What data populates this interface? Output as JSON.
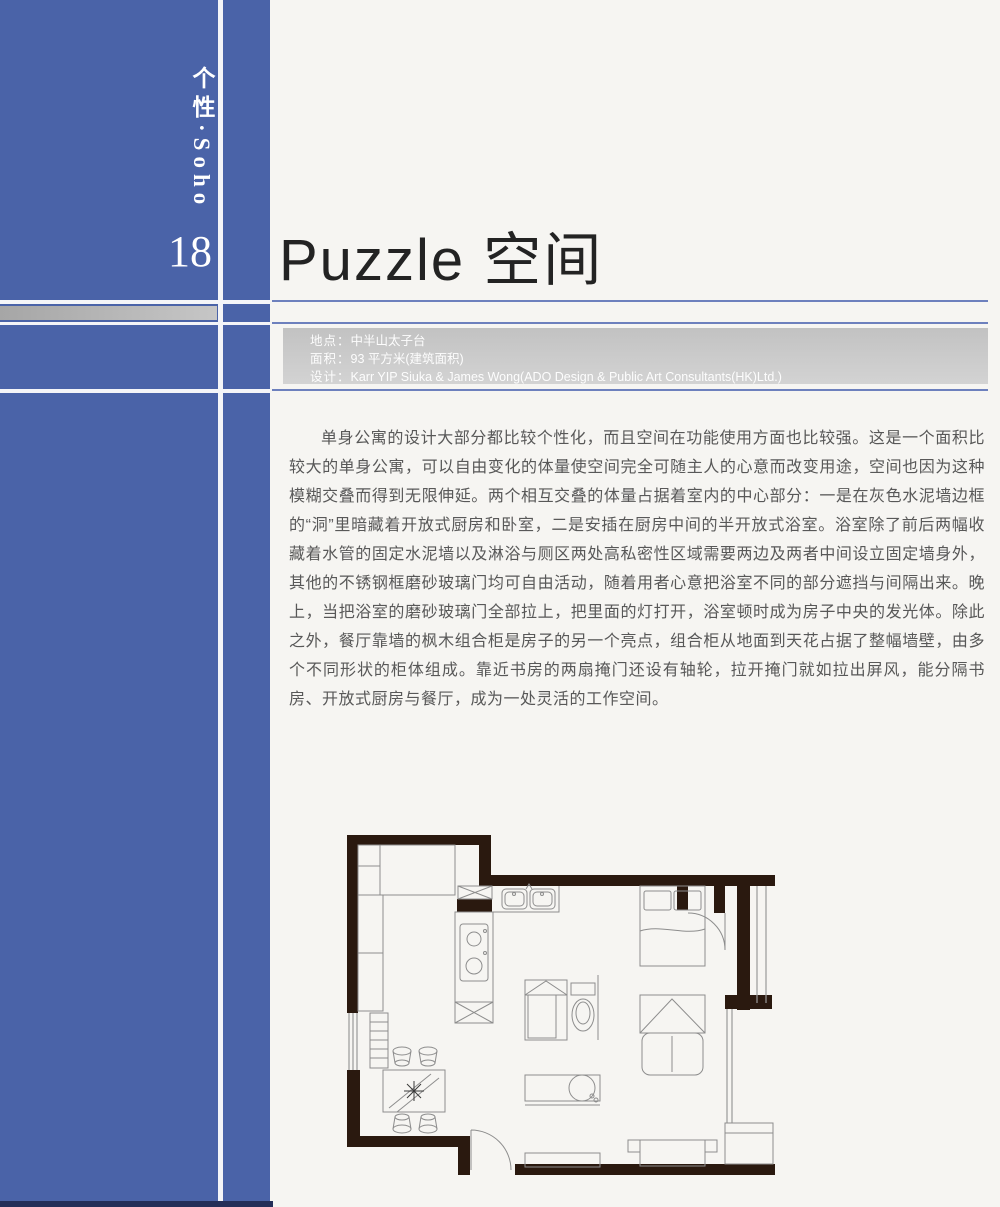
{
  "colors": {
    "sidebar_blue": "#4a63a8",
    "rule_blue": "#6d80bd",
    "gray_bar": "#b9b9b9",
    "info_box_gray": "#c9c9c9",
    "bottom_edge_navy": "#242e58"
  },
  "sidebar": {
    "category": "个性·Soho",
    "page_number": "18"
  },
  "header": {
    "title": "Puzzle 空间"
  },
  "info": {
    "rows": [
      {
        "label": "地点：",
        "value": "中半山太子台"
      },
      {
        "label": "面积：",
        "value": "93 平方米(建筑面积)"
      },
      {
        "label": "设计：",
        "value": "Karr YIP Siuka & James Wong(ADO Design & Public Art Consultants(HK)Ltd.)"
      }
    ]
  },
  "article": {
    "paragraph": "单身公寓的设计大部分都比较个性化，而且空间在功能使用方面也比较强。这是一个面积比较大的单身公寓，可以自由变化的体量使空间完全可随主人的心意而改变用途，空间也因为这种模糊交叠而得到无限伸延。两个相互交叠的体量占据着室内的中心部分：一是在灰色水泥墙边框的“洞”里暗藏着开放式厨房和卧室，二是安插在厨房中间的半开放式浴室。浴室除了前后两幅收藏着水管的固定水泥墙以及淋浴与厕区两处高私密性区域需要两边及两者中间设立固定墙身外，其他的不锈钢框磨砂玻璃门均可自由活动，随着用者心意把浴室不同的部分遮挡与间隔出来。晚上，当把浴室的磨砂玻璃门全部拉上，把里面的灯打开，浴室顿时成为房子中央的发光体。除此之外，餐厅靠墙的枫木组合柜是房子的另一个亮点，组合柜从地面到天花占据了整幅墙壁，由多个不同形状的柜体组成。靠近书房的两扇掩门还设有轴轮，拉开掩门就如拉出屏风，能分隔书房、开放式厨房与餐厅，成为一处灵活的工作空间。"
  }
}
